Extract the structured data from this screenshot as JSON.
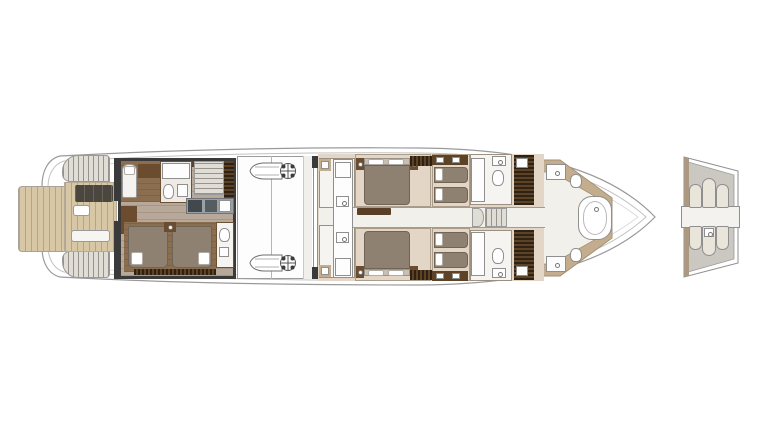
{
  "plan": {
    "type": "yacht-lower-deck-floor-plan",
    "labels": {
      "swim_platform": "swim platform",
      "stern_stairs_port": "stern stairs port",
      "stern_stairs_starboard": "stern stairs starboard",
      "cockpit": "beach club cockpit",
      "crew_quarters": "crew quarters",
      "engine_room": "engine room",
      "guest_area": "guest cabins area",
      "corridor": "guest corridor",
      "vip_bathroom": "forward bathroom with tub",
      "bow": "bow",
      "transom_detail": "transom mechanism detail"
    },
    "icons": [
      "engine-icon",
      "flywheel-icon",
      "toilet-icon",
      "sink-icon",
      "bathtub-icon",
      "bed-icon",
      "stairs-icon",
      "sofa-icon",
      "table-icon"
    ]
  },
  "colors": {
    "hull_line": "#9a9a9a",
    "hull_inner_line": "#c2c2c2",
    "sheer_line": "#dcdcdc",
    "deck_wood": "#d8c7a5",
    "crew_floor": "#b7a899",
    "crew_cabin_floor": "#8b6e50",
    "brown_cabinet": "#6c4c2e",
    "dark_wall": "#3a3a3a",
    "dark_wardrobe_a": "#2f2113",
    "dark_wardrobe_b": "#5d4326",
    "bed_taupe": "#8e8171",
    "headboard": "#c6bfb2",
    "guest_carpet": "#e3d6c7",
    "corridor_floor": "#f2f0ea",
    "bath_floor": "#f6f4f0",
    "fixture_white": "#fdfdfd",
    "vip_tan": "#c3ad8e",
    "panel_gray": "#cbc8c2",
    "cylinder_fill": "#e9e5da",
    "counter_gray": "#9aa1a5",
    "appliance_dark": "#42484c",
    "steps_gray": "#e0ddd6",
    "sofa_charcoal": "#4b473f",
    "engine_line": "#6f6f6f"
  }
}
